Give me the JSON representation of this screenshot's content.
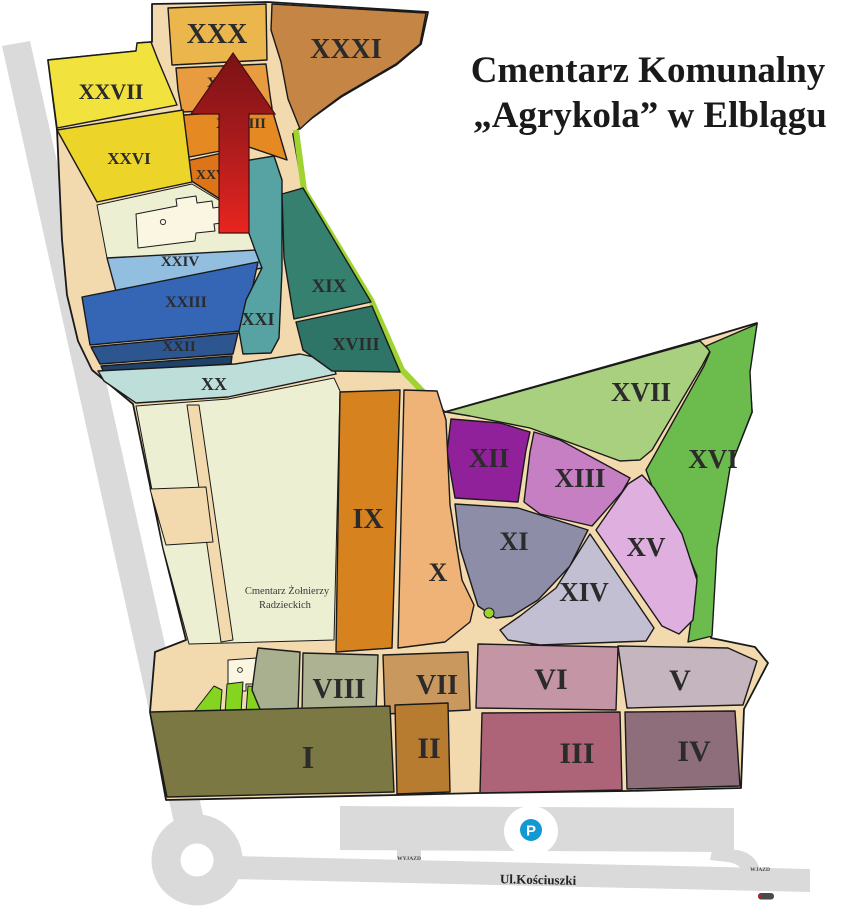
{
  "title": {
    "line1": "Cmentarz Komunalny",
    "line2": "„Agrykola” w Elblągu"
  },
  "map": {
    "sections": {
      "I": {
        "label": "I",
        "color": "#7b7843"
      },
      "II": {
        "label": "II",
        "color": "#b87c31"
      },
      "III": {
        "label": "III",
        "color": "#ad6478"
      },
      "IV": {
        "label": "IV",
        "color": "#8d6e7a"
      },
      "V": {
        "label": "V",
        "color": "#c4b5bf"
      },
      "VI": {
        "label": "VI",
        "color": "#c495a5"
      },
      "VII": {
        "label": "VII",
        "color": "#c9985e"
      },
      "VIII": {
        "label": "VIII",
        "color": "#acb292"
      },
      "IX": {
        "label": "IX",
        "color": "#d6821f"
      },
      "X": {
        "label": "X",
        "color": "#efb377"
      },
      "XI": {
        "label": "XI",
        "color": "#8d8da8"
      },
      "XII": {
        "label": "XII",
        "color": "#91219b"
      },
      "XIII": {
        "label": "XIII",
        "color": "#c77fc4"
      },
      "XIV": {
        "label": "XIV",
        "color": "#c1bfd1"
      },
      "XV": {
        "label": "XV",
        "color": "#dfafdf"
      },
      "XVI": {
        "label": "XVI",
        "color": "#6cbb4d"
      },
      "XVII": {
        "label": "XVII",
        "color": "#a9d07e"
      },
      "XVIII": {
        "label": "XVIII",
        "color": "#2f7567"
      },
      "XIX": {
        "label": "XIX",
        "color": "#35806e"
      },
      "XX": {
        "label": "XX",
        "color": "#bededa"
      },
      "XXI": {
        "label": "XXI",
        "color": "#57a3a3"
      },
      "XXII": {
        "label": "XXII",
        "color": "#2d5590"
      },
      "XXIII": {
        "label": "XXIII",
        "color": "#3566b5"
      },
      "XXIV": {
        "label": "XXIV",
        "color": "#92bedf"
      },
      "XXV": {
        "label": "XXV",
        "color": "#dd7417"
      },
      "XXVI": {
        "label": "XXVI",
        "color": "#edd428"
      },
      "XXVII": {
        "label": "XXVII",
        "color": "#f2e23e"
      },
      "XXVIII": {
        "label": "XXVIII",
        "color": "#e58a22"
      },
      "XXIX": {
        "label": "XXIX",
        "color": "#e99c3f"
      },
      "XXX": {
        "label": "XXX",
        "color": "#ebb64c"
      },
      "XXXI": {
        "label": "XXXI",
        "color": "#c58544"
      }
    },
    "landmarks": {
      "soviet_line1": "Cmentarz Żołnierzy",
      "soviet_line2": "Radzieckich"
    }
  },
  "streets": {
    "agrykola": "Ul.Agrykola",
    "kosciuszki": "Ul.Kościuszki"
  },
  "road_labels": {
    "exit": "WYJAZD",
    "entrance": "WJAZD"
  },
  "parking": {
    "symbol": "P"
  },
  "colors": {
    "road": "#dadada",
    "path_base": "#f3daae",
    "pale_green": "#ecefd2",
    "building": "#faf6e2",
    "bright_green": "#85d420",
    "strip_green": "#9ed331",
    "navy_strip": "#1e4269",
    "sage_wedge": "#a9b08f",
    "parking_blue": "#1299d4",
    "arrow_dark": "#7a1215",
    "arrow_mid": "#a51a1c",
    "arrow_bright": "#e8251f",
    "car": "#4a4a4a"
  }
}
